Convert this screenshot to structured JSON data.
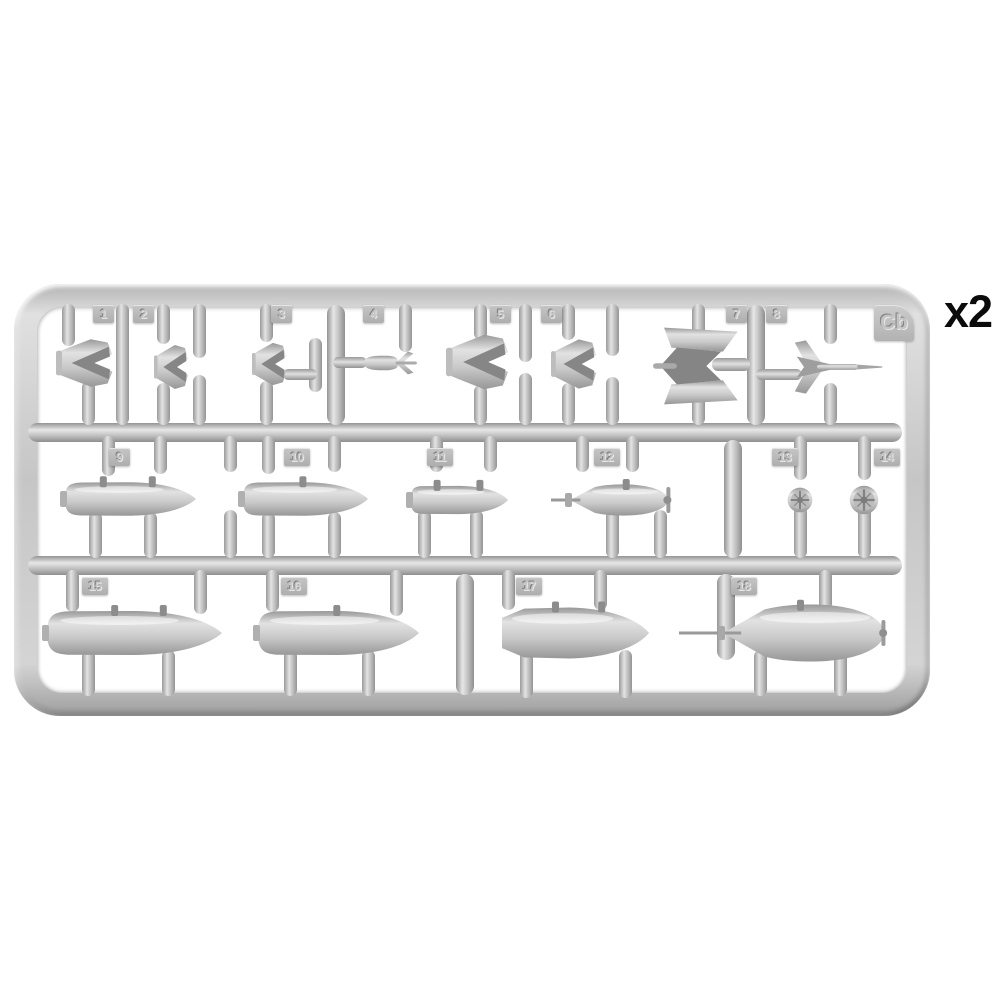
{
  "annotation": {
    "quantity_label": "x2"
  },
  "sprue": {
    "gate_label": "Cb",
    "plastic_color": "#c6c6c6",
    "background_color": "#ffffff",
    "parts": [
      {
        "number": "1",
        "shape": "box-fin-tail-unit"
      },
      {
        "number": "2",
        "shape": "box-fin-tail-unit"
      },
      {
        "number": "3",
        "shape": "box-fin-tail-unit"
      },
      {
        "number": "4",
        "shape": "small-finned-bomb"
      },
      {
        "number": "5",
        "shape": "box-fin-tail-unit"
      },
      {
        "number": "6",
        "shape": "box-fin-tail-unit"
      },
      {
        "number": "7",
        "shape": "large-plate-fin-tail-unit"
      },
      {
        "number": "8",
        "shape": "dart-fin-tail-unit"
      },
      {
        "number": "9",
        "shape": "bomb-body-half"
      },
      {
        "number": "10",
        "shape": "bomb-body-half"
      },
      {
        "number": "11",
        "shape": "bomb-body-half"
      },
      {
        "number": "12",
        "shape": "bomb-body-with-nose-spike"
      },
      {
        "number": "13",
        "shape": "arming-vane-disc"
      },
      {
        "number": "14",
        "shape": "arming-vane-disc"
      },
      {
        "number": "15",
        "shape": "large-bomb-body-half"
      },
      {
        "number": "16",
        "shape": "large-bomb-body-half"
      },
      {
        "number": "17",
        "shape": "large-bomb-body-boat-tail"
      },
      {
        "number": "18",
        "shape": "large-bomb-body-with-nose-spike"
      }
    ]
  }
}
